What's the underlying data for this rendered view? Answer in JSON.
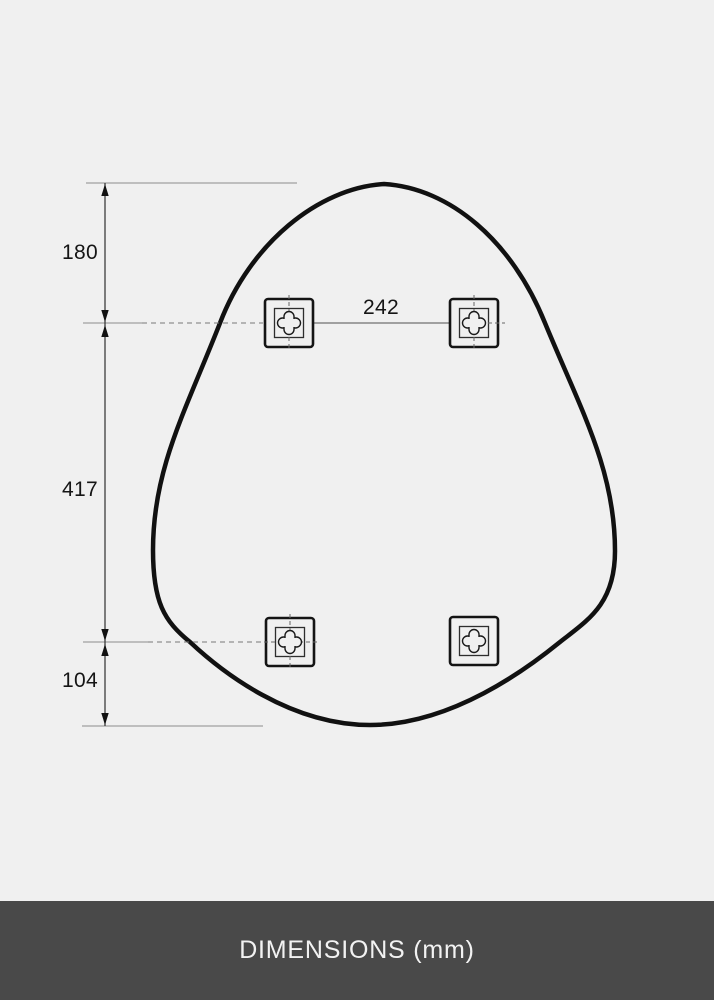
{
  "diagram": {
    "background_color": "#f0f0f0",
    "outline_color": "#111111",
    "line_color": "#8c8c8c",
    "labels": {
      "top_edge_to_holes": "180",
      "holes_horizontal_spacing": "242",
      "holes_vertical_spacing": "417",
      "holes_to_bottom_edge": "104"
    },
    "shape": "egg-shaped mirror outline with four square wall-mount brackets"
  },
  "footer": {
    "title": "DIMENSIONS (mm)",
    "background_color": "#494949",
    "text_color": "#f2f2f2"
  }
}
